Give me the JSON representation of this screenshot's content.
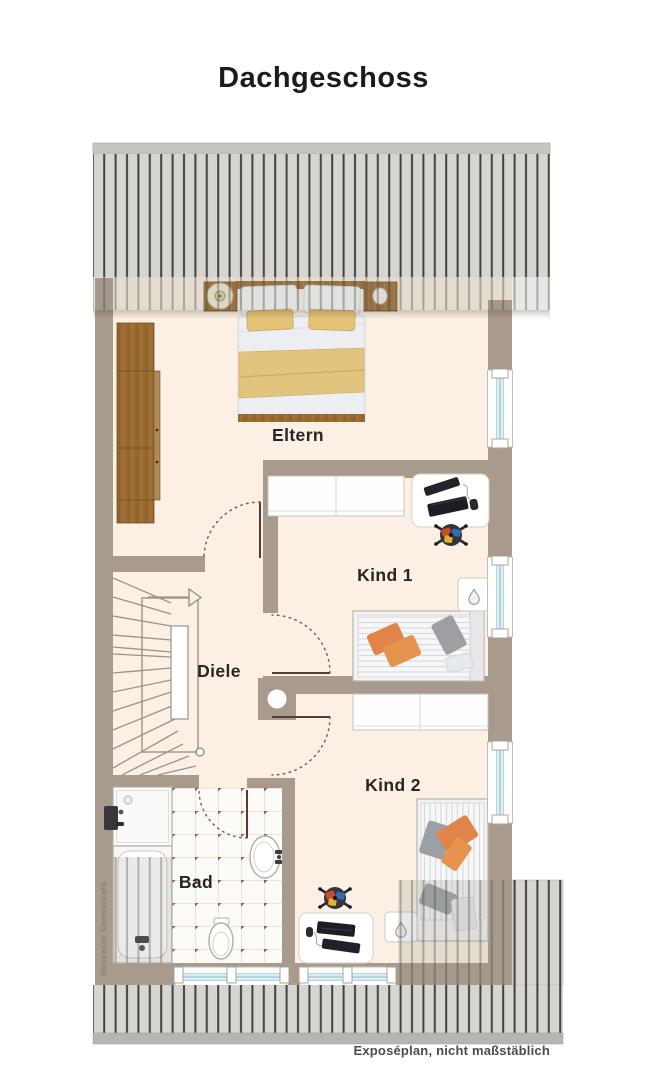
{
  "title": "Dachgeschoss",
  "plan": {
    "rooms": {
      "eltern": {
        "label": "Eltern"
      },
      "kind1": {
        "label": "Kind 1"
      },
      "kind2": {
        "label": "Kind 2"
      },
      "diele": {
        "label": "Diele"
      },
      "bad": {
        "label": "Bad"
      }
    },
    "stair_direction": "up",
    "furniture": {
      "eltern": [
        "wardrobe",
        "double-bed",
        "nightstand-left",
        "nightstand-right",
        "table-lamp",
        "deco-stone"
      ],
      "kind1": [
        "wardrobe",
        "desk",
        "monitor",
        "keyboard",
        "mouse",
        "desk-chair",
        "single-bed",
        "small-cabinet"
      ],
      "kind2": [
        "wardrobe",
        "single-bed",
        "desk",
        "monitor",
        "keyboard",
        "mouse",
        "desk-chair",
        "small-cabinet"
      ],
      "diele": [
        "staircase",
        "stair-direction-arrow"
      ],
      "bad": [
        "shower",
        "bathtub",
        "washbasin",
        "toilet"
      ]
    },
    "windows": {
      "right_wall": 3,
      "bottom_wall": 2
    }
  },
  "watermark": "Illustration ©ImmoGrafik",
  "footer": {
    "note": "Exposéplan, nicht maßstäblich"
  },
  "palette": {
    "background": "#ffffff",
    "wall": "#a89a8c",
    "floor": "#fbf0e3",
    "roof_fill": "#d7d5d2",
    "roof_stripe": "#43413e",
    "roof_base_band": "#b7b5b2",
    "wood": "#9a6a31",
    "window_glass": "#dceef3",
    "blanket_yellow": "#e3c47e",
    "pillow_orange": "#e08447",
    "tile_dot": "#a05a3c",
    "label_color": "#262626"
  }
}
